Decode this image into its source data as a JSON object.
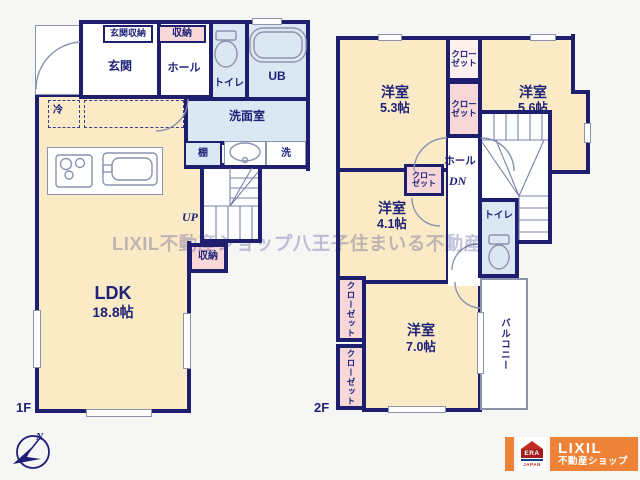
{
  "watermark": "LIXIL不動産ショップ八王子住まいる不動産",
  "floor1": {
    "label": "1F",
    "genkan": "玄関",
    "genkan_storage": "玄関収納",
    "storage_top": "収納",
    "hall": "ホール",
    "toilet": "トイレ",
    "bath": "UB",
    "washroom": "洗面室",
    "shelf": "棚",
    "laundry": "洗",
    "fridge": "冷",
    "stair_up": "UP",
    "stair_storage": "収納",
    "ldk": {
      "name": "LDK",
      "size": "18.8帖"
    }
  },
  "floor2": {
    "label": "2F",
    "hall": "ホール",
    "stair_down": "DN",
    "toilet": "トイレ",
    "balcony": "バルコニー",
    "closet_line1": "クロー",
    "closet_line2": "ゼット",
    "closet_vertical": "クローゼット",
    "rooms": {
      "r53": {
        "name": "洋室",
        "size": "5.3帖"
      },
      "r56": {
        "name": "洋室",
        "size": "5.6帖"
      },
      "r41": {
        "name": "洋室",
        "size": "4.1帖"
      },
      "r70": {
        "name": "洋室",
        "size": "7.0帖"
      }
    }
  },
  "compass": {
    "north": "N"
  },
  "logo": {
    "brand": "LIXIL",
    "shop": "不動産ショップ",
    "emblem": "ERA",
    "emblem_country": "JAPAN"
  },
  "colors": {
    "wall_navy": "#1e1e6e",
    "room_cream": "#faeac6",
    "closet_pink": "#f7d7d7",
    "wet_area_blue": "#dbe8f4",
    "logo_orange": "#ee8338"
  }
}
